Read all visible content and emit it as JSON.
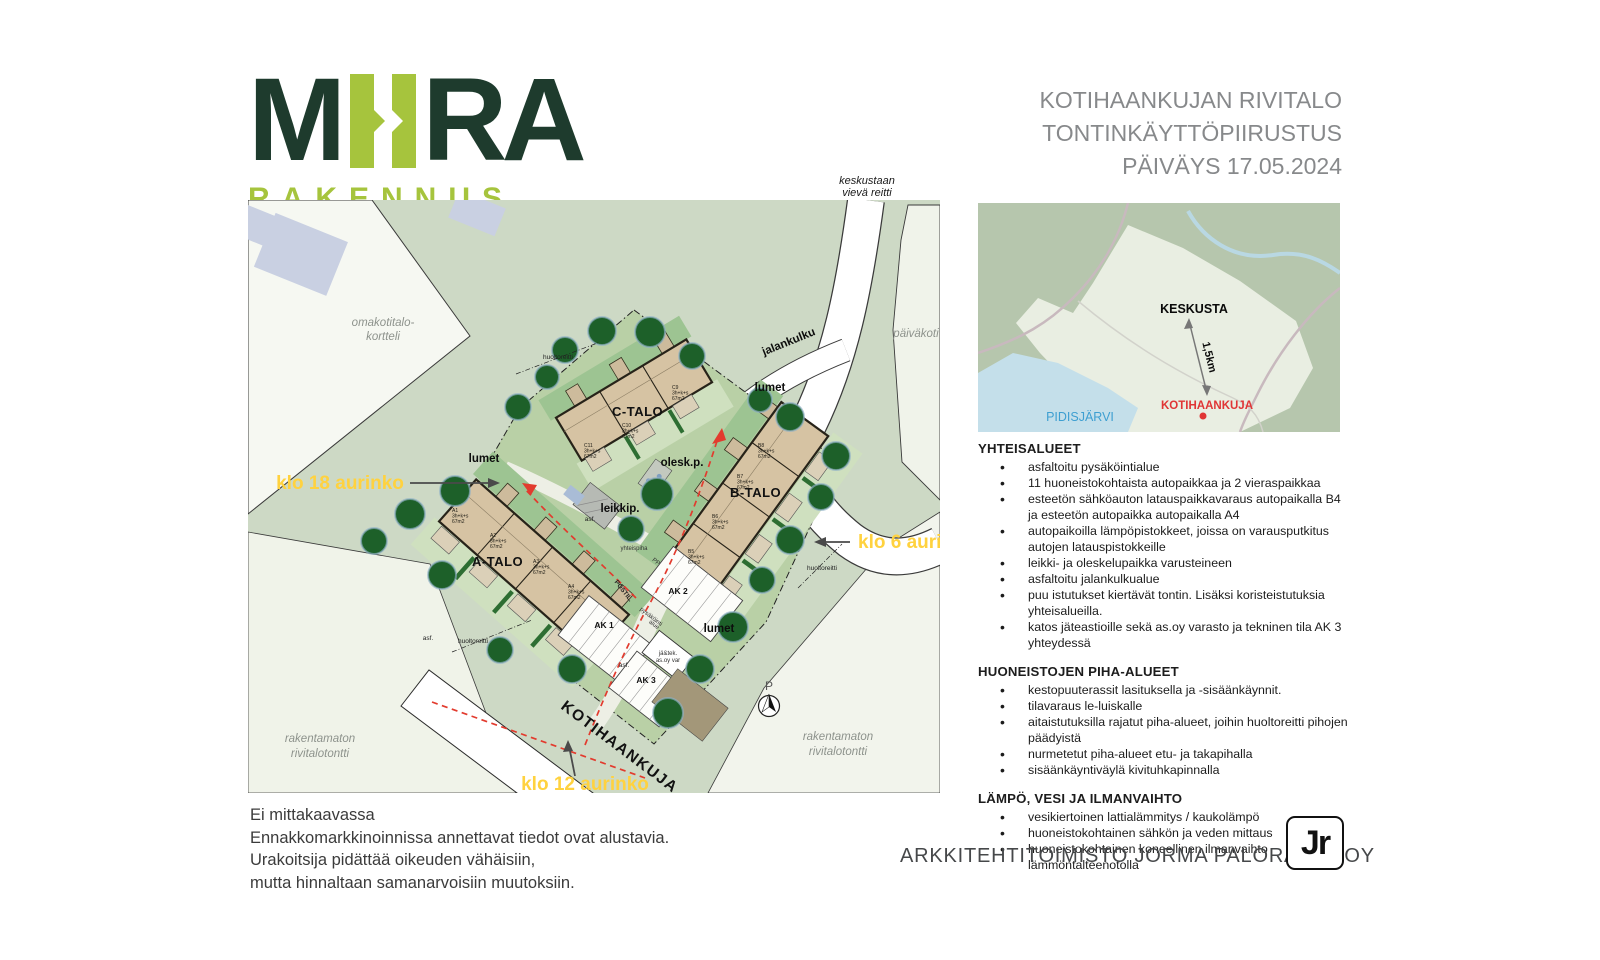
{
  "logo": {
    "m": "M",
    "ra": "RA",
    "sub": "RAKENNUS"
  },
  "header": {
    "line1": "KOTIHAANKUJAN RIVITALO",
    "line2": "TONTINKÄYTTÖPIIRUSTUS",
    "line3": "PÄIVÄYS 17.05.2024"
  },
  "plan": {
    "route_to_center": {
      "line1": "keskustaan",
      "line2": "vievä reitti"
    },
    "walk": "jalankulku",
    "street": "KOTIHAANKUJA",
    "snow": "lumet",
    "sun": {
      "evening": "klo 18 aurinko",
      "morning": "klo 6 aurinko",
      "noon": "klo 12 aurinko"
    },
    "areas": {
      "omakotitalo": {
        "line1": "omakotitalo-",
        "line2": "kortteli"
      },
      "paivakoti": "päiväkoti",
      "vacant_left": {
        "line1": "rakentamaton",
        "line2": "rivitalotontti"
      },
      "vacant_right": {
        "line1": "rakentamaton",
        "line2": "rivitalotontti"
      }
    },
    "labels": {
      "olesk": "olesk.p.",
      "leikki": "leikkip.",
      "yhteispiha": "yhteispiha",
      "asf": "asf.",
      "huoltoreitti": "huoltoreitti",
      "postil": "POSTIL.",
      "pys1": "pysäköinti",
      "pys2": "alue",
      "pp": "PP",
      "ak1": "AK 1",
      "ak2": "AK 2",
      "ak3": "AK 3",
      "jate1": "jä&tek.",
      "jate2": "as.oy var",
      "compass": "P"
    },
    "buildings": [
      {
        "name": "A-TALO",
        "units": [
          {
            "code": "A1",
            "rooms": "3h+k+s",
            "area": "67m2"
          },
          {
            "code": "A2",
            "rooms": "3h+k+s",
            "area": "67m2"
          },
          {
            "code": "A3",
            "rooms": "3h+k+s",
            "area": "67m2"
          },
          {
            "code": "A4",
            "rooms": "3h+k+s",
            "area": "67m2"
          }
        ]
      },
      {
        "name": "B-TALO",
        "units": [
          {
            "code": "B8",
            "rooms": "3h+k+s",
            "area": "67m2"
          },
          {
            "code": "B7",
            "rooms": "3h+k+s",
            "area": "67m2"
          },
          {
            "code": "B6",
            "rooms": "3h+k+s",
            "area": "67m2"
          },
          {
            "code": "B5",
            "rooms": "3h+k+s",
            "area": "67m2"
          }
        ]
      },
      {
        "name": "C-TALO",
        "units": [
          {
            "code": "C9",
            "rooms": "3h+k+s",
            "area": "67m2"
          },
          {
            "code": "C10",
            "rooms": "3h+k+s",
            "area": "67m2"
          },
          {
            "code": "C11",
            "rooms": "3h+k+s",
            "area": "67m2"
          }
        ]
      }
    ]
  },
  "map": {
    "keskusta": "KESKUSTA",
    "distance": "1,5km",
    "site": "KOTIHAANKUJA",
    "lake": "PIDISJÄRVI"
  },
  "sections": [
    {
      "heading": "YHTEISALUEET",
      "bullets": [
        "asfaltoitu pysäköintialue",
        "11 huoneistokohtaista autopaikkaa ja 2 vieraspaikkaa",
        "esteetön sähköauton latauspaikkavaraus autopaikalla B4 ja esteetön autopaikka autopaikalla A4",
        "autopaikoilla lämpöpistokkeet, joissa on varausputkitus autojen latauspistokkeille",
        "leikki- ja oleskelupaikka varusteineen",
        "asfaltoitu jalankulkualue",
        "puu istutukset kiertävät tontin. Lisäksi koristeistutuksia yhteisalueilla.",
        "katos jäteastioille sekä as.oy varasto ja tekninen tila AK 3 yhteydessä"
      ]
    },
    {
      "heading": "HUONEISTOJEN PIHA-ALUEET",
      "bullets": [
        "kestopuuterassit lasituksella ja -sisäänkäynnit.",
        "tilavaraus le-luiskalle",
        "aitaistutuksilla rajatut piha-alueet, joihin huoltoreitti pihojen päädyistä",
        "nurmetetut piha-alueet etu- ja takapihalla",
        "sisäänkäyntiväylä kivituhkapinnalla"
      ]
    },
    {
      "heading": "LÄMPÖ, VESI JA ILMANVAIHTO",
      "bullets": [
        "vesikiertoinen lattialämmitys / kaukolämpö",
        "huoneistokohtainen sähkön ja veden mittaus",
        "huoneistokohtainen koneellinen ilmanvaihto lämmöntalteenotolla"
      ]
    }
  ],
  "disclaimer": {
    "line1": "Ei mittakaavassa",
    "line2": "Ennakkomarkkinoinnissa annettavat tiedot ovat alustavia.",
    "line3": "Urakoitsija pidättää oikeuden vähäisiin,",
    "line4": "mutta hinnaltaan samanarvoisiin muutoksiin."
  },
  "footer": {
    "firm": "ARKKITEHTITOIMISTO JORMA PALORANTA OY",
    "stamp": "Jr"
  },
  "colors": {
    "brand_dark": "#1e3b2d",
    "brand_green": "#a6c43d",
    "sun_yellow": "#ffd23f",
    "route_red": "#e23b2e",
    "map_red": "#e03535",
    "lake_blue": "#3e9fd1"
  }
}
